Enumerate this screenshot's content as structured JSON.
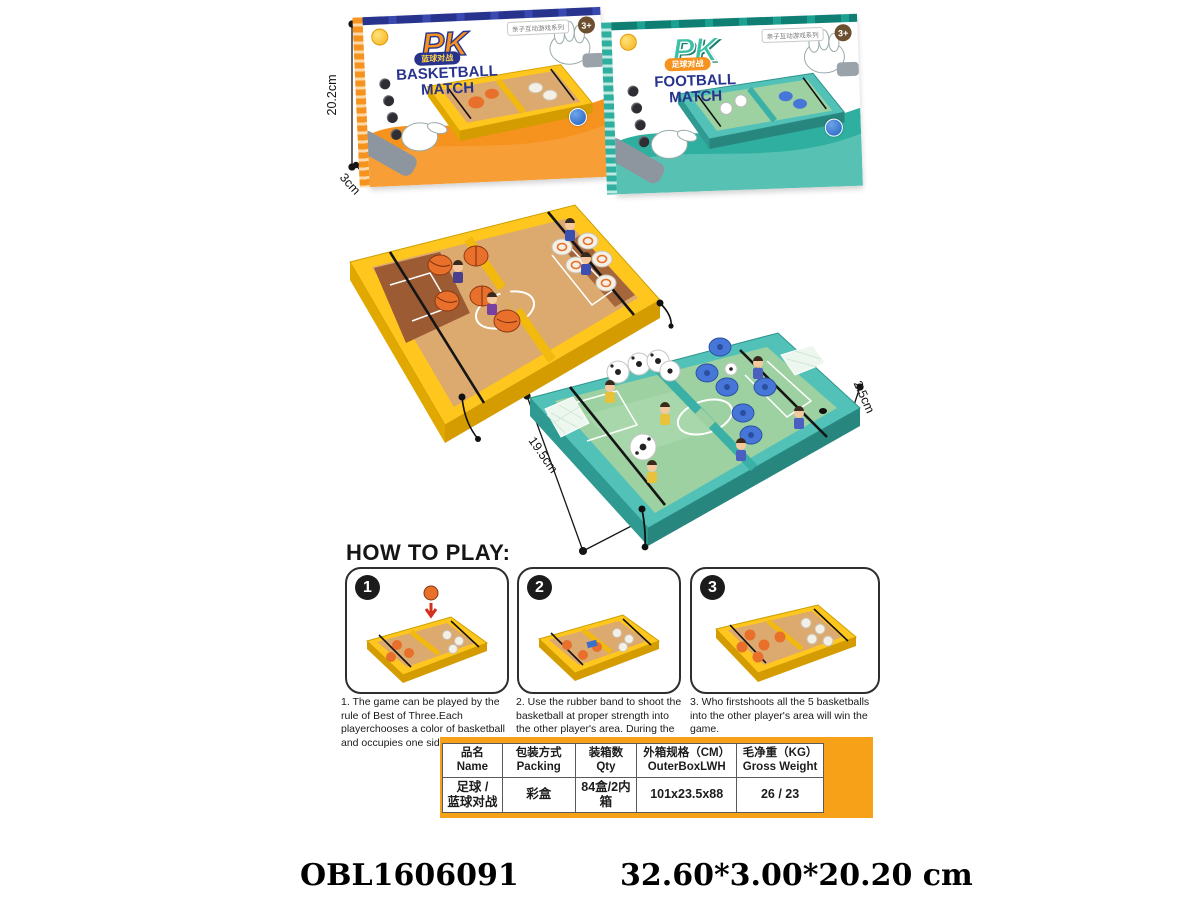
{
  "colors": {
    "orange": "#F6921E",
    "panel_orange": "#F7A119",
    "navy": "#27338C",
    "teal": "#2FAF9F",
    "board_yellow": "#FFC61E",
    "wood": "#DCA96E",
    "field_green": "#9ED1A1",
    "ball_orange": "#E8702A",
    "puck_blue": "#4677D8"
  },
  "boxes": {
    "basketball": {
      "pk": "PK",
      "banner": "蓝球对战",
      "title_line1": "BASKETBALL",
      "title_line2": "MATCH",
      "age_badge": "3+",
      "series_badge": "亲子互动游戏系列"
    },
    "football": {
      "pk": "PK",
      "banner": "足球对战",
      "title_line1": "FOOTBALL",
      "title_line2": "MATCH",
      "age_badge": "3+",
      "series_badge": "亲子互动游戏系列"
    }
  },
  "dimensions": {
    "box_height": "20.2cm",
    "box_depth": "3cm",
    "box_width": "32.6cm",
    "board_height": "19.5cm",
    "board_width": "32cm",
    "board_depth": "2.5cm"
  },
  "how_to_play": {
    "heading": "HOW TO PLAY:",
    "steps": [
      {
        "number": "1",
        "text": "1. The game can be played by the rule of Best of Three.Each playerchooses a color of basketball and occupies one side of the court."
      },
      {
        "number": "2",
        "text": "2. Use the rubber band to shoot the basketball at proper strength into the other player's area. During the game, who pops the basketball out of the field will lose the game."
      },
      {
        "number": "3",
        "text": "3. Who firstshoots all the 5 basketballs into the other player's area will win the game."
      }
    ]
  },
  "spec_table": {
    "columns": [
      {
        "cn": "品名",
        "en": "Name"
      },
      {
        "cn": "包装方式",
        "en": "Packing"
      },
      {
        "cn": "装箱数",
        "en": "Qty"
      },
      {
        "cn": "外箱规格（CM）",
        "en": "OuterBoxLWH"
      },
      {
        "cn": "毛净重（KG）",
        "en": "Gross Weight"
      }
    ],
    "row": {
      "name_line1": "足球 /",
      "name_line2": "蓝球对战",
      "packing": "彩盒",
      "qty": "84盒/2内箱",
      "outer": "101x23.5x88",
      "gross_weight": "26 / 23"
    }
  },
  "footer": {
    "sku": "OBL1606091",
    "size": "32.60*3.00*20.20 cm"
  }
}
